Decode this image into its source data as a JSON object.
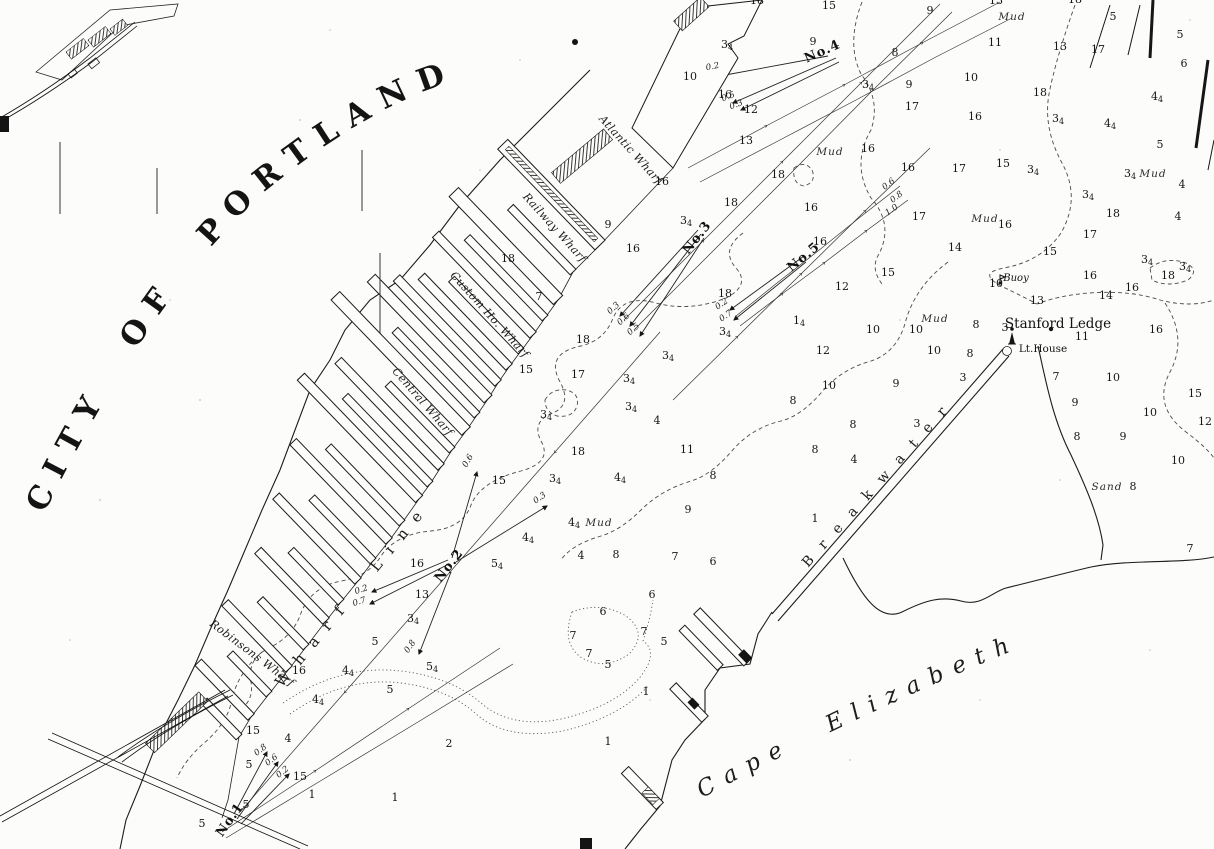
{
  "chart": {
    "title": "CITY OF PORTLAND",
    "labels": {
      "cape": "Cape Elizabeth",
      "breakwater": "Breakwater",
      "wharf_line": "Wharf Line",
      "stanford_ledge": "Stanford Ledge",
      "lighthouse": "Lt.House",
      "buoy": "Buoy",
      "sand": "Sand",
      "mud": "Mud"
    },
    "wharves": [
      {
        "name": "Atlantic Wharf",
        "x": 628,
        "y": 152,
        "rot": 48
      },
      {
        "name": "Railway Wharf",
        "x": 552,
        "y": 230,
        "rot": 48
      },
      {
        "name": "Custom Ho. Wharf",
        "x": 487,
        "y": 317,
        "rot": 48
      },
      {
        "name": "Central Wharf",
        "x": 420,
        "y": 404,
        "rot": 49
      },
      {
        "name": "Robinsons Wharf",
        "x": 250,
        "y": 656,
        "rot": 37
      }
    ],
    "stations": [
      {
        "label": "No.1",
        "x": 233,
        "y": 822,
        "rot": -55
      },
      {
        "label": "No.2",
        "x": 452,
        "y": 568,
        "rot": -52
      },
      {
        "label": "No.3",
        "x": 700,
        "y": 240,
        "rot": -52
      },
      {
        "label": "No.4",
        "x": 824,
        "y": 55,
        "rot": -24
      },
      {
        "label": "No.5",
        "x": 806,
        "y": 260,
        "rot": -40
      }
    ],
    "current_speeds": [
      {
        "t": "0.3",
        "x": 615,
        "y": 310,
        "rot": -42
      },
      {
        "t": "0.6",
        "x": 625,
        "y": 321,
        "rot": -42
      },
      {
        "t": "0.5",
        "x": 635,
        "y": 331,
        "rot": -42
      },
      {
        "t": "0.2",
        "x": 723,
        "y": 306,
        "rot": -35
      },
      {
        "t": "0.7",
        "x": 727,
        "y": 318,
        "rot": -35
      },
      {
        "t": "0.6",
        "x": 890,
        "y": 186,
        "rot": -38
      },
      {
        "t": "0.8",
        "x": 898,
        "y": 199,
        "rot": -38
      },
      {
        "t": "1.0",
        "x": 893,
        "y": 212,
        "rot": -35
      },
      {
        "t": "0.2",
        "x": 713,
        "y": 69,
        "rot": -12
      },
      {
        "t": "0.5",
        "x": 729,
        "y": 99,
        "rot": -20
      },
      {
        "t": "0.3",
        "x": 737,
        "y": 107,
        "rot": -20
      },
      {
        "t": "0.2",
        "x": 362,
        "y": 592,
        "rot": -18
      },
      {
        "t": "0.7",
        "x": 360,
        "y": 604,
        "rot": -18
      },
      {
        "t": "0.6",
        "x": 470,
        "y": 462,
        "rot": -60
      },
      {
        "t": "0.3",
        "x": 541,
        "y": 500,
        "rot": -35
      },
      {
        "t": "0.8",
        "x": 412,
        "y": 648,
        "rot": -55
      },
      {
        "t": "0.8",
        "x": 262,
        "y": 752,
        "rot": -38
      },
      {
        "t": "0.6",
        "x": 273,
        "y": 762,
        "rot": -38
      },
      {
        "t": "0.2",
        "x": 284,
        "y": 774,
        "rot": -38
      }
    ],
    "mud_positions": [
      [
        1012,
        20
      ],
      [
        830,
        155
      ],
      [
        985,
        222
      ],
      [
        1153,
        177
      ],
      [
        935,
        322
      ],
      [
        599,
        526
      ]
    ],
    "soundings": [
      [
        757,
        4,
        "18"
      ],
      [
        996,
        4,
        "13"
      ],
      [
        1075,
        3,
        "18"
      ],
      [
        930,
        14,
        "9"
      ],
      [
        1113,
        20,
        "5"
      ],
      [
        829,
        9,
        "15"
      ],
      [
        813,
        45,
        "9"
      ],
      [
        995,
        46,
        "11"
      ],
      [
        1060,
        50,
        "13"
      ],
      [
        1098,
        53,
        "17"
      ],
      [
        895,
        56,
        "8"
      ],
      [
        727,
        48,
        "3^4"
      ],
      [
        1180,
        38,
        "5"
      ],
      [
        690,
        80,
        "10"
      ],
      [
        971,
        81,
        "10"
      ],
      [
        1184,
        67,
        "6"
      ],
      [
        868,
        88,
        "3^4"
      ],
      [
        909,
        88,
        "9"
      ],
      [
        1040,
        96,
        "18"
      ],
      [
        1157,
        100,
        "4^4"
      ],
      [
        912,
        110,
        "17"
      ],
      [
        751,
        113,
        "12"
      ],
      [
        725,
        98,
        "16"
      ],
      [
        975,
        120,
        "16"
      ],
      [
        1058,
        122,
        "3^4"
      ],
      [
        1110,
        127,
        "4^4"
      ],
      [
        1160,
        148,
        "5"
      ],
      [
        746,
        144,
        "13"
      ],
      [
        868,
        152,
        "16"
      ],
      [
        778,
        178,
        "18"
      ],
      [
        662,
        185,
        "16"
      ],
      [
        1003,
        167,
        "15"
      ],
      [
        1033,
        173,
        "3^4"
      ],
      [
        1130,
        177,
        "3^4"
      ],
      [
        959,
        172,
        "17"
      ],
      [
        908,
        171,
        "16"
      ],
      [
        811,
        211,
        "16"
      ],
      [
        1088,
        198,
        "3^4"
      ],
      [
        1182,
        188,
        "4"
      ],
      [
        731,
        206,
        "18"
      ],
      [
        919,
        220,
        "17"
      ],
      [
        686,
        224,
        "3^4"
      ],
      [
        608,
        228,
        "9"
      ],
      [
        1113,
        217,
        "18"
      ],
      [
        1178,
        220,
        "4"
      ],
      [
        1005,
        228,
        "16"
      ],
      [
        955,
        251,
        "14"
      ],
      [
        633,
        252,
        "16"
      ],
      [
        1050,
        255,
        "15"
      ],
      [
        820,
        245,
        "16"
      ],
      [
        1090,
        238,
        "17"
      ],
      [
        508,
        262,
        "18"
      ],
      [
        1147,
        263,
        "3^4"
      ],
      [
        1185,
        270,
        "3^4"
      ],
      [
        888,
        276,
        "15"
      ],
      [
        1168,
        279,
        "18"
      ],
      [
        1132,
        291,
        "16"
      ],
      [
        725,
        297,
        "18"
      ],
      [
        539,
        300,
        "7"
      ],
      [
        1106,
        299,
        "14"
      ],
      [
        996,
        287,
        "10"
      ],
      [
        842,
        290,
        "12"
      ],
      [
        1090,
        279,
        "16"
      ],
      [
        725,
        335,
        "3^4"
      ],
      [
        799,
        324,
        "1^4"
      ],
      [
        1037,
        304,
        "13"
      ],
      [
        976,
        328,
        "8"
      ],
      [
        1005,
        331,
        "3"
      ],
      [
        1082,
        340,
        "11"
      ],
      [
        1156,
        333,
        "16"
      ],
      [
        873,
        333,
        "10"
      ],
      [
        916,
        333,
        "10"
      ],
      [
        823,
        354,
        "12"
      ],
      [
        934,
        354,
        "10"
      ],
      [
        970,
        357,
        "8"
      ],
      [
        583,
        343,
        "18"
      ],
      [
        668,
        359,
        "3^4"
      ],
      [
        578,
        378,
        "17"
      ],
      [
        526,
        373,
        "15"
      ],
      [
        629,
        382,
        "3^4"
      ],
      [
        963,
        381,
        "3"
      ],
      [
        1056,
        380,
        "7"
      ],
      [
        1113,
        381,
        "10"
      ],
      [
        829,
        389,
        "10"
      ],
      [
        896,
        387,
        "9"
      ],
      [
        631,
        410,
        "3^4"
      ],
      [
        546,
        418,
        "3^4"
      ],
      [
        1195,
        397,
        "15"
      ],
      [
        657,
        424,
        "4"
      ],
      [
        917,
        427,
        "3"
      ],
      [
        853,
        428,
        "8"
      ],
      [
        793,
        404,
        "8"
      ],
      [
        687,
        453,
        "11"
      ],
      [
        578,
        455,
        "18"
      ],
      [
        1150,
        416,
        "10"
      ],
      [
        1205,
        425,
        "12"
      ],
      [
        1123,
        440,
        "9"
      ],
      [
        815,
        453,
        "8"
      ],
      [
        854,
        463,
        "4"
      ],
      [
        620,
        481,
        "4^4"
      ],
      [
        555,
        482,
        "3^4"
      ],
      [
        499,
        484,
        "15"
      ],
      [
        1075,
        406,
        "9"
      ],
      [
        1077,
        440,
        "8"
      ],
      [
        688,
        513,
        "9"
      ],
      [
        713,
        479,
        "8"
      ],
      [
        1178,
        464,
        "10"
      ],
      [
        1133,
        490,
        "8"
      ],
      [
        574,
        526,
        "4^4"
      ],
      [
        815,
        522,
        "1"
      ],
      [
        528,
        541,
        "4^4"
      ],
      [
        581,
        559,
        "4"
      ],
      [
        616,
        558,
        "8"
      ],
      [
        675,
        560,
        "7"
      ],
      [
        713,
        565,
        "6"
      ],
      [
        497,
        567,
        "5^4"
      ],
      [
        417,
        567,
        "16"
      ],
      [
        1190,
        552,
        "7"
      ],
      [
        422,
        598,
        "13"
      ],
      [
        652,
        598,
        "6"
      ],
      [
        603,
        615,
        "6"
      ],
      [
        413,
        622,
        "3^4"
      ],
      [
        644,
        635,
        "7"
      ],
      [
        573,
        639,
        "7"
      ],
      [
        664,
        645,
        "5"
      ],
      [
        375,
        645,
        "5"
      ],
      [
        589,
        657,
        "7"
      ],
      [
        608,
        668,
        "5"
      ],
      [
        348,
        674,
        "4^4"
      ],
      [
        432,
        670,
        "5^4"
      ],
      [
        299,
        674,
        "16"
      ],
      [
        390,
        693,
        "5"
      ],
      [
        646,
        695,
        "1"
      ],
      [
        318,
        703,
        "4^4"
      ],
      [
        253,
        734,
        "15"
      ],
      [
        288,
        742,
        "4"
      ],
      [
        449,
        747,
        "2"
      ],
      [
        249,
        768,
        "5"
      ],
      [
        300,
        780,
        "15"
      ],
      [
        312,
        798,
        "1"
      ],
      [
        395,
        801,
        "1"
      ],
      [
        246,
        808,
        "5"
      ],
      [
        202,
        827,
        "5"
      ],
      [
        608,
        745,
        "1"
      ]
    ]
  }
}
